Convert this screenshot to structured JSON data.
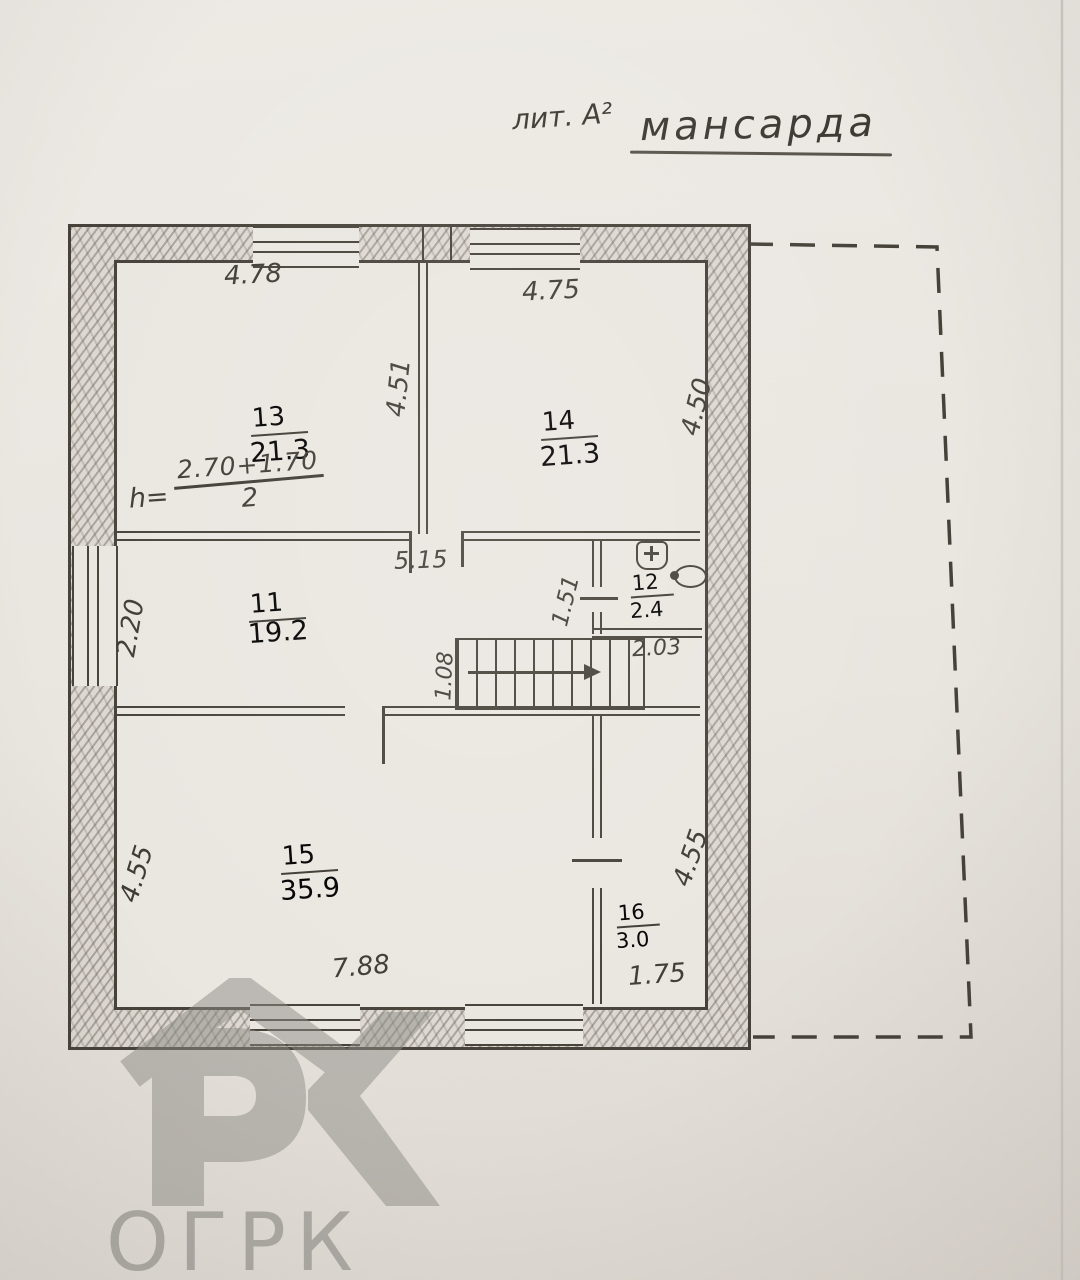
{
  "title": {
    "lit": "лит. А²",
    "name": "мансарда"
  },
  "formula": {
    "lhs": "h=",
    "num": "2.70+1.70",
    "den": "2"
  },
  "rooms": {
    "r13": {
      "number": "13",
      "area": "21.3"
    },
    "r14": {
      "number": "14",
      "area": "21.3"
    },
    "r11": {
      "number": "11",
      "area": "19.2"
    },
    "r12": {
      "number": "12",
      "area": "2.4"
    },
    "r15": {
      "number": "15",
      "area": "35.9"
    },
    "r16": {
      "number": "16",
      "area": "3.0"
    }
  },
  "dimensions": {
    "room13_width": "4.78",
    "room14_width": "4.75",
    "room13_depth": "4.51",
    "room14_depth": "4.50",
    "room11_width": "5.15",
    "room11_left": "2.20",
    "room12_left": "1.51",
    "landing_width": "2.03",
    "stairs_width": "1.08",
    "room15_left": "4.55",
    "room16_right": "4.55",
    "room15_width": "7.88",
    "room16_width": "1.75"
  },
  "watermark": {
    "text": "ОГРК"
  },
  "colors": {
    "paper": "#e9e5df",
    "line": "#474239",
    "watermark": "#8d8a86"
  }
}
